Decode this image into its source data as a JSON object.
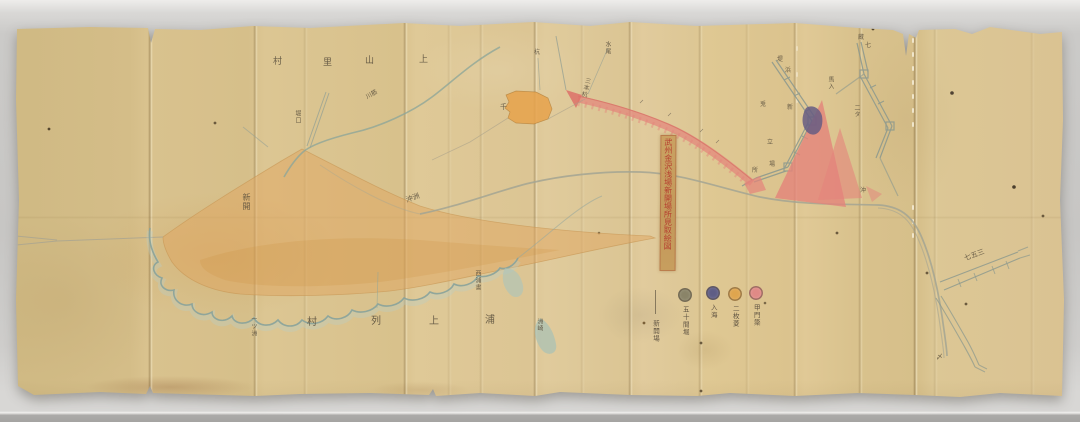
{
  "photo": {
    "backdrop_color": "#c9c8c6",
    "paper_color": "#d9c28e"
  },
  "map": {
    "title_strip": {
      "text": "武州金沢浅場新開場所見取絵図",
      "ink_color": "#b5372c"
    },
    "legend": {
      "items": [
        {
          "label": "新開場",
          "swatch": "line",
          "color": "#6b5f4a"
        },
        {
          "label": "五十間堀",
          "swatch": "circle",
          "color": "#8a8468"
        },
        {
          "label": "入海",
          "swatch": "circle",
          "color": "#5f5d85"
        },
        {
          "label": "二枚菱",
          "swatch": "circle",
          "color": "#dfa54e"
        },
        {
          "label": "甲門簗",
          "swatch": "circle",
          "color": "#e08a86"
        }
      ]
    },
    "region_colors": {
      "new_field_wash": "#dfa660",
      "embankment_wash": "#e4837b",
      "water_line": "#8fa699",
      "sluice_patch": "#665c82"
    },
    "labels": [
      {
        "text": "村",
        "x": 273,
        "y": 58,
        "size": 9
      },
      {
        "text": "里",
        "x": 323,
        "y": 59,
        "size": 9
      },
      {
        "text": "山",
        "x": 365,
        "y": 57,
        "size": 9
      },
      {
        "text": "上",
        "x": 419,
        "y": 56,
        "size": 9
      },
      {
        "text": "一ツ洲",
        "x": 250,
        "y": 316,
        "size": 6,
        "v": 1
      },
      {
        "text": "村",
        "x": 307,
        "y": 318,
        "size": 10
      },
      {
        "text": "列",
        "x": 371,
        "y": 317,
        "size": 10
      },
      {
        "text": "上",
        "x": 429,
        "y": 317,
        "size": 10
      },
      {
        "text": "浦",
        "x": 485,
        "y": 316,
        "size": 10
      },
      {
        "text": "洲崎",
        "x": 536,
        "y": 318,
        "size": 6,
        "v": 1
      },
      {
        "text": "西浦書",
        "x": 474,
        "y": 270,
        "size": 6,
        "v": 1
      },
      {
        "text": "新開",
        "x": 242,
        "y": 193,
        "size": 8,
        "v": 1
      },
      {
        "text": "沖洲",
        "x": 406,
        "y": 195,
        "size": 7,
        "rot": -20
      },
      {
        "text": "堀口",
        "x": 294,
        "y": 110,
        "size": 6,
        "v": 1
      },
      {
        "text": "川筋",
        "x": 366,
        "y": 92,
        "size": 6,
        "rot": -30
      },
      {
        "text": "水尾",
        "x": 604,
        "y": 41,
        "size": 6,
        "v": 1
      },
      {
        "text": "杭",
        "x": 534,
        "y": 50,
        "size": 6
      },
      {
        "text": "三本杭",
        "x": 582,
        "y": 77,
        "size": 6,
        "v": 1,
        "rot": 14
      },
      {
        "text": "千",
        "x": 500,
        "y": 104,
        "size": 7
      },
      {
        "text": "七五三",
        "x": 964,
        "y": 252,
        "size": 7,
        "rot": -20
      },
      {
        "text": "堤",
        "x": 777,
        "y": 57,
        "size": 6
      },
      {
        "text": "浜",
        "x": 785,
        "y": 68,
        "size": 6
      },
      {
        "text": "馬入",
        "x": 827,
        "y": 76,
        "size": 6,
        "v": 1
      },
      {
        "text": "兎",
        "x": 760,
        "y": 102,
        "size": 6
      },
      {
        "text": "新",
        "x": 787,
        "y": 105,
        "size": 6
      },
      {
        "text": "二タ",
        "x": 853,
        "y": 104,
        "size": 6,
        "v": 1
      },
      {
        "text": "立",
        "x": 767,
        "y": 140,
        "size": 6
      },
      {
        "text": "場",
        "x": 769,
        "y": 162,
        "size": 6
      },
      {
        "text": "所",
        "x": 752,
        "y": 168,
        "size": 6
      },
      {
        "text": "沖",
        "x": 860,
        "y": 188,
        "size": 6
      },
      {
        "text": "蔵",
        "x": 858,
        "y": 35,
        "size": 6
      },
      {
        "text": "七",
        "x": 865,
        "y": 43,
        "size": 6
      },
      {
        "text": "〆",
        "x": 936,
        "y": 354,
        "size": 7
      }
    ]
  }
}
